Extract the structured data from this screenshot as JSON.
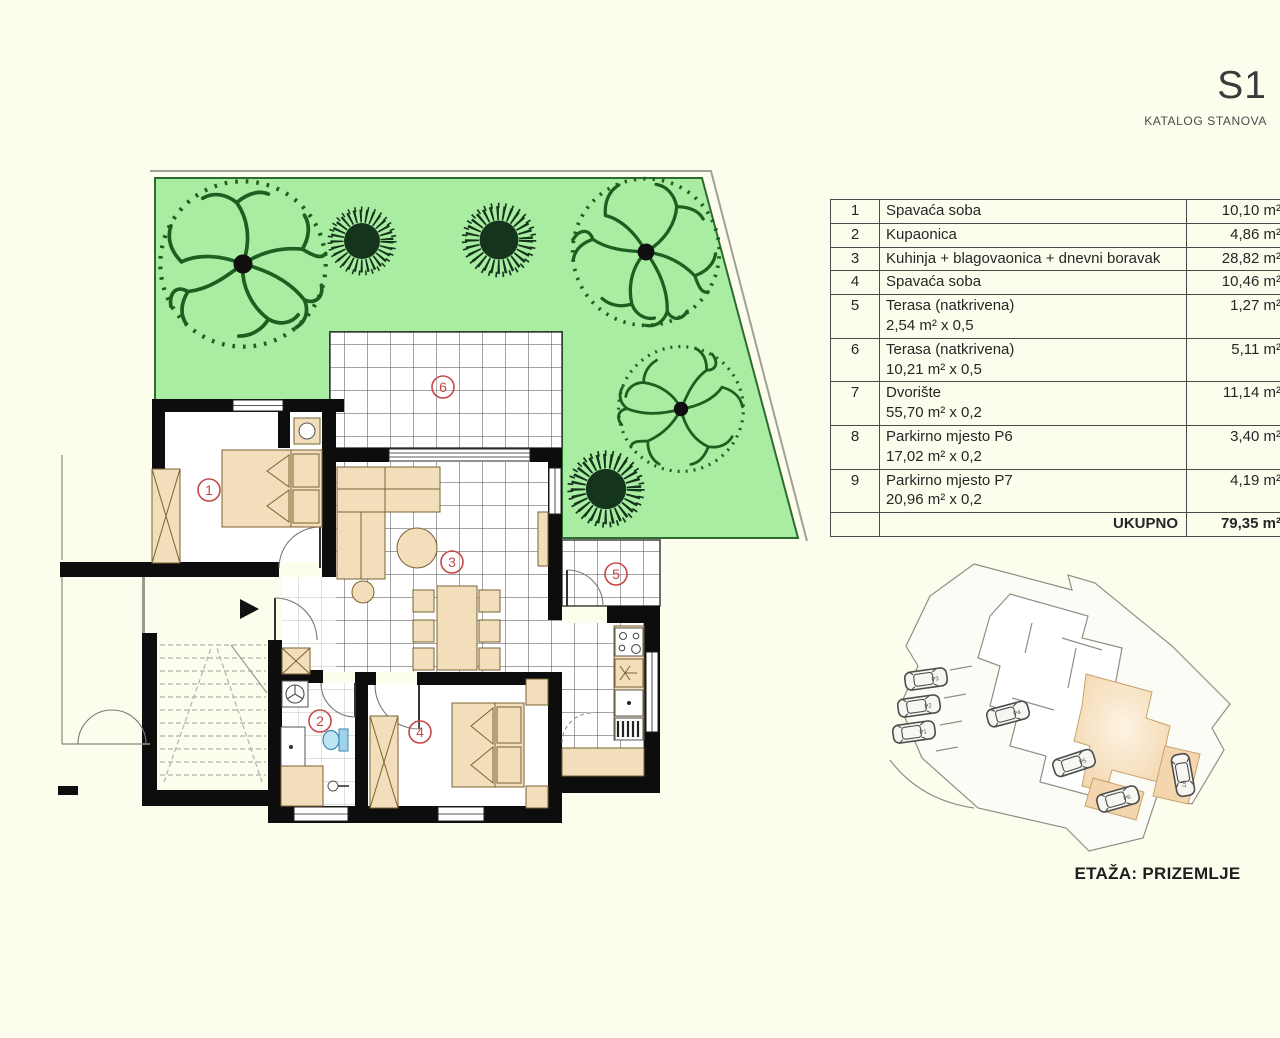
{
  "header": {
    "title": "S1",
    "subtitle": "KATALOG STANOVA"
  },
  "area_table": {
    "rows": [
      {
        "num": "1",
        "label": "Spavaća soba",
        "sub": "",
        "area": "10,10  m²"
      },
      {
        "num": "2",
        "label": "Kupaonica",
        "sub": "",
        "area": "4,86 m²"
      },
      {
        "num": "3",
        "label": "Kuhinja + blagovaonica + dnevni boravak",
        "sub": "",
        "area": "28,82 m²"
      },
      {
        "num": "4",
        "label": "Spavaća soba",
        "sub": "",
        "area": "10,46 m²"
      },
      {
        "num": "5",
        "label": "Terasa (natkrivena)",
        "sub": "2,54 m² x 0,5",
        "area": "1,27 m²"
      },
      {
        "num": "6",
        "label": "Terasa (natkrivena)",
        "sub": "10,21 m² x 0,5",
        "area": "5,11 m²"
      },
      {
        "num": "7",
        "label": "Dvorište",
        "sub": "55,70 m² x 0,2",
        "area": "11,14 m²"
      },
      {
        "num": "8",
        "label": "Parkirno mjesto P6",
        "sub": "17,02 m² x 0,2",
        "area": "3,40 m²"
      },
      {
        "num": "9",
        "label": "Parkirno mjesto P7",
        "sub": "20,96 m² x 0,2",
        "area": "4,19 m²"
      }
    ],
    "total_label": "UKUPNO",
    "total_area": "79,35 m²"
  },
  "floor_plan": {
    "markers": [
      "1",
      "2",
      "3",
      "4",
      "5",
      "6"
    ]
  },
  "site_plan": {
    "caption": "ETAŽA: PRIZEMLJE",
    "parking_labels": [
      "P3",
      "P2",
      "P1",
      "P4",
      "P5",
      "P6",
      "P7"
    ]
  },
  "colors": {
    "page_bg": "#fdfdee",
    "garden_green": "#a9eda3",
    "garden_border": "#2f6b2f",
    "wall_black": "#0d0d0d",
    "furniture_tan": "#f3debc",
    "furniture_outline": "#7a6233",
    "marker_red": "#c64747",
    "unit_highlight": "#f3d6ad"
  }
}
